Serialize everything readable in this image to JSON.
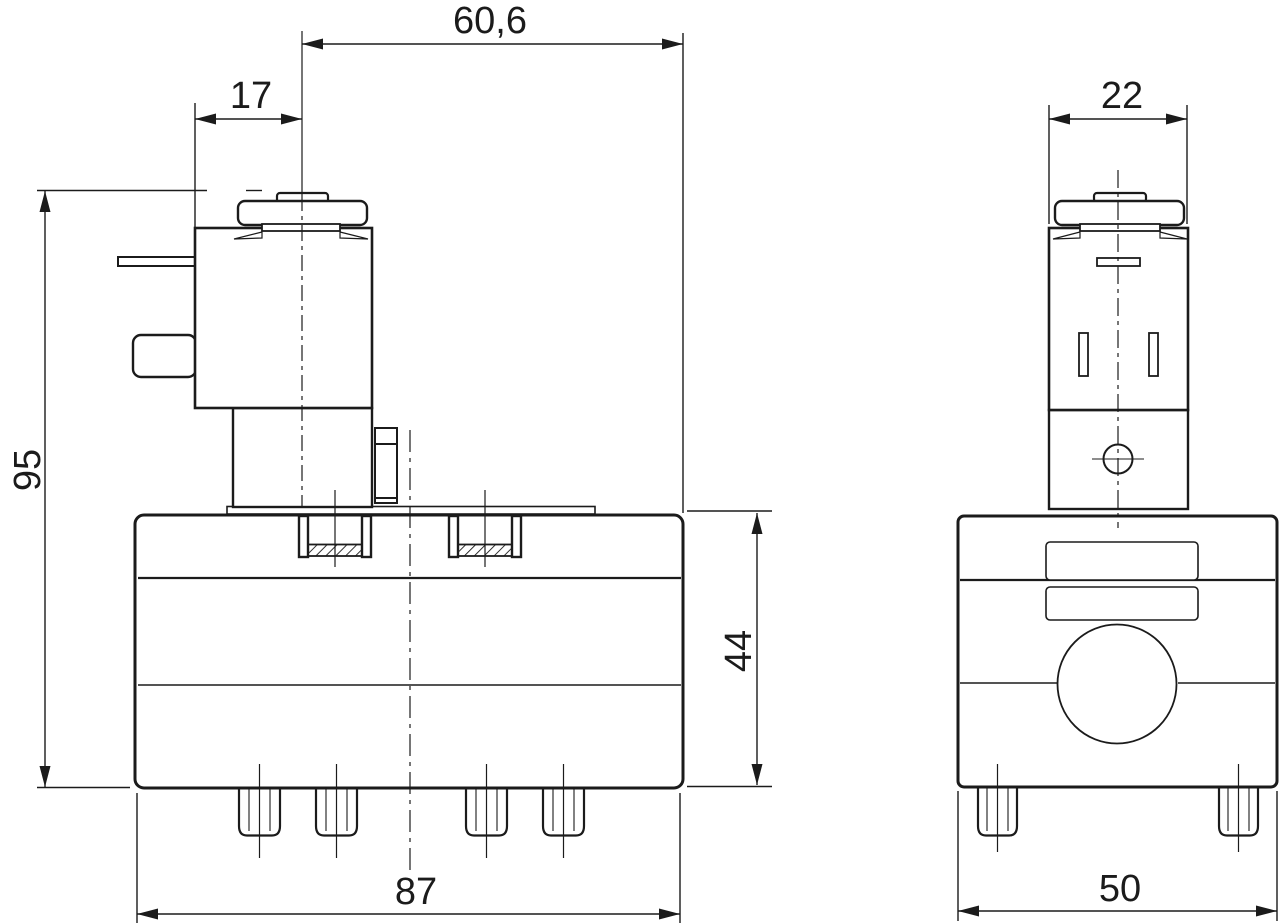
{
  "page": {
    "background": "#ffffff",
    "line_color": "#1b1b1b",
    "description": "Two-view dimensioned engineering drawing of a solenoid valve"
  },
  "dims": {
    "top_span": "60,6",
    "coil_width": "17",
    "total_height": "95",
    "body_height": "44",
    "body_width": "87",
    "front_coil_width": "22",
    "front_body_width": "50"
  }
}
